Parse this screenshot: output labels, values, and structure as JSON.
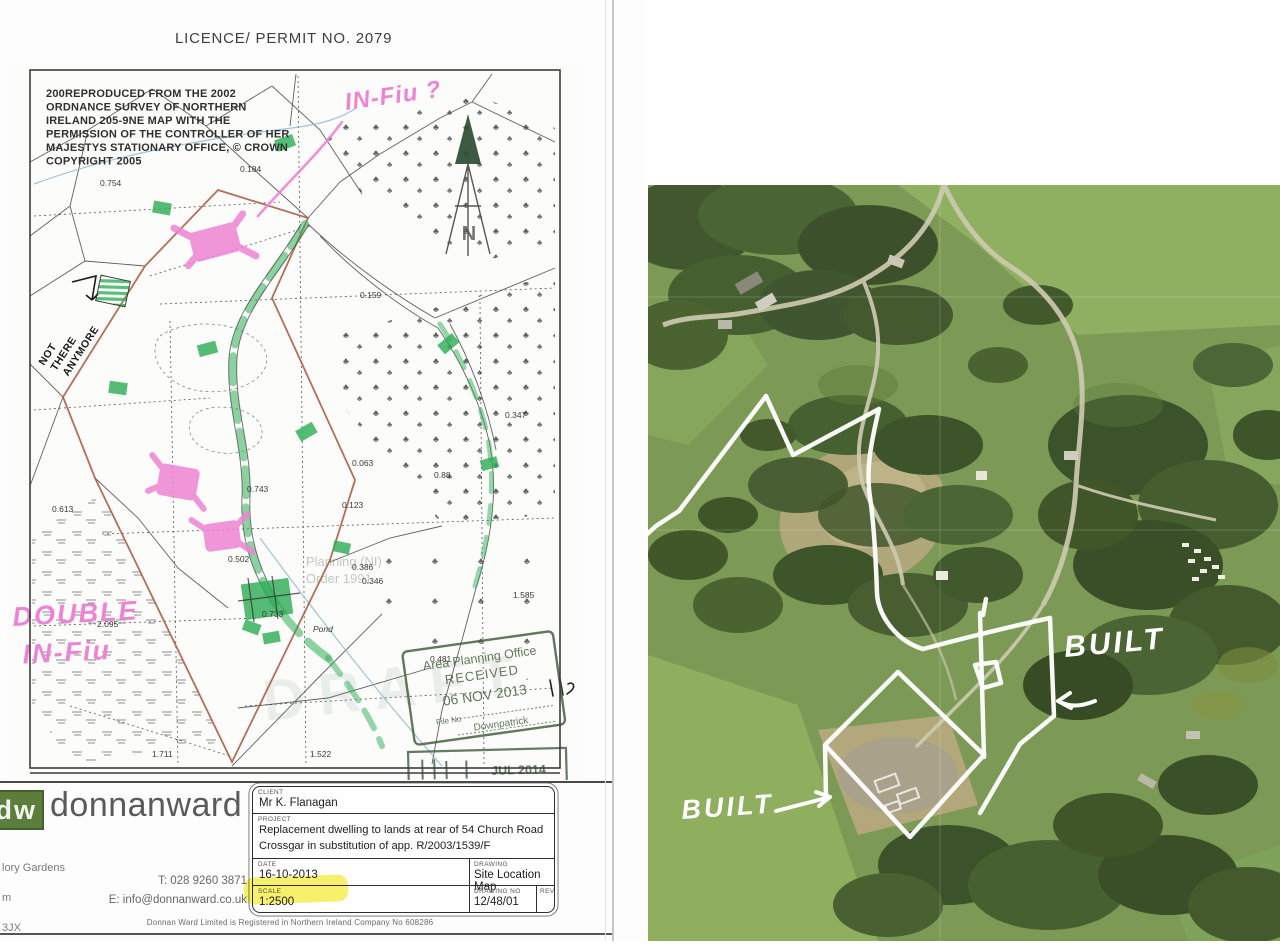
{
  "page": {
    "licence_title": "LICENCE/ PERMIT NO. 2079"
  },
  "map": {
    "copyright_lines": [
      "200REPRODUCED FROM THE 2002",
      "ORDNANCE SURVEY OF NORTHERN",
      "IRELAND 205-9NE MAP WITH THE",
      "PERMISSION OF THE CONTROLLER OF HER",
      "MAJESTYS STATIONARY OFFICE, © CROWN",
      "COPYRIGHT 2005"
    ],
    "north_label": "N",
    "tree_symbol": "♣",
    "pond_label": "Pond",
    "parcels": [
      "0.754",
      "0.184",
      "0.159",
      "0.063",
      "0.88",
      "0.123",
      "0.347",
      "0.743",
      "0.502",
      "0.386",
      "0.733",
      "1.585",
      "2.095",
      "0.613",
      "0.481",
      "1.711",
      "1.522",
      "0.346"
    ],
    "watermark": {
      "line1": "Planning (NI)",
      "line2": "Order 1991",
      "draft": "DRAFT"
    },
    "stamp": {
      "office": "Area Planning Office",
      "received": "RECEIVED",
      "date_received": "06 NOV 2013",
      "file_no": "File No",
      "district": "Downpatrick",
      "second_date": "JUL 2014"
    },
    "handwriting": {
      "infill_query": "IN-Fiu ?",
      "not_there": [
        "NOT",
        "THERE",
        "ANYMORE"
      ],
      "double_1": "DOUBLE",
      "double_2": "IN-Fiu"
    }
  },
  "title_block": {
    "logo_short": "dw",
    "logo_name": "donnanward",
    "address_fragments": [
      "lory Gardens",
      "m",
      "3JX"
    ],
    "phone": "T: 028 9260 3871",
    "email": "E: info@donnanward.co.uk",
    "labels": {
      "client": "CLIENT",
      "project": "PROJECT",
      "date": "DATE",
      "drawing": "DRAWING",
      "scale": "SCALE",
      "drawing_no": "DRAWING NO",
      "rev": "REV"
    },
    "client": "Mr K. Flanagan",
    "project_line1": "Replacement dwelling to lands at rear of 54 Church Road",
    "project_line2": "Crossgar in substitution of app. R/2003/1539/F",
    "date": "16-10-2013",
    "drawing": "Site Location Map",
    "scale": "1:2500",
    "drawing_no": "12/48/01",
    "footer": "Donnan Ward Limited is Registered in Northern Ireland Company No 608286"
  },
  "aerial": {
    "annotations": {
      "built_left": "BUILT",
      "built_right": "BUILT"
    }
  },
  "colors": {
    "highlighter_pink": "#ef83d3",
    "highlighter_green": "#2fae57",
    "highlighter_yellow": "#f4ec3a",
    "boundary_red": "#a8553b",
    "stamp_green": "#47603f",
    "marker_white": "#ffffff"
  }
}
